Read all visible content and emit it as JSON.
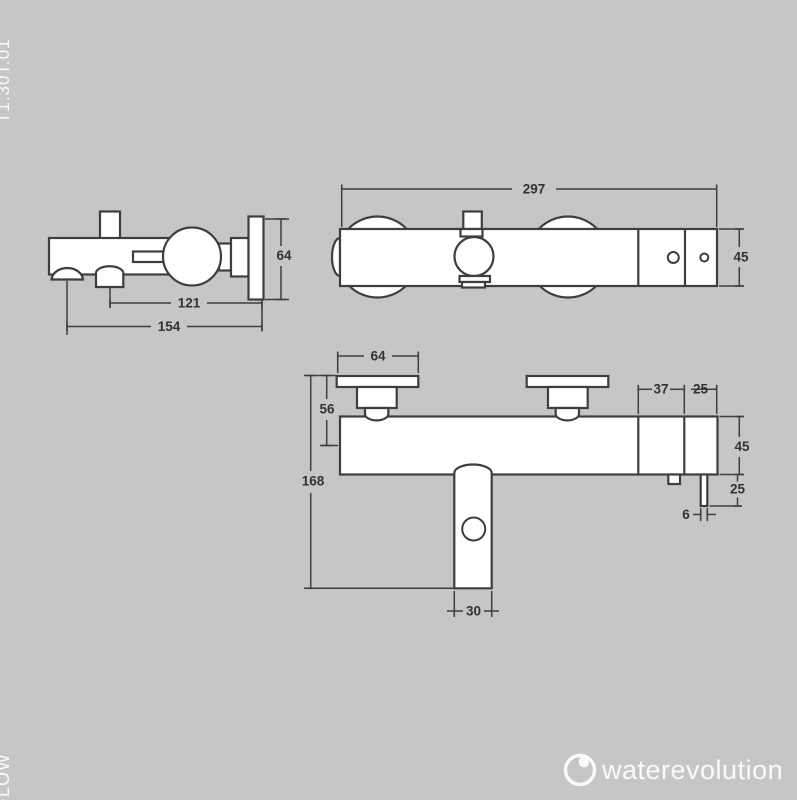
{
  "header": {
    "product_code": "T1.30T.01"
  },
  "footer": {
    "series": "FLOW",
    "brand": "waterevolution"
  },
  "colors": {
    "background": "#c5c6c8",
    "line": "#3e3e40",
    "fill": "#ffffff",
    "text_dark": "#333335",
    "text_light": "#fafafa"
  },
  "dims": {
    "side_spout_depth": "154",
    "side_diverter_depth": "121",
    "side_plate": "64",
    "top_width": "297",
    "top_depth": "45",
    "front_plate_width": "64",
    "front_plate_drop": "56",
    "front_height": "168",
    "front_span_37": "37",
    "front_span_25": "25",
    "front_body_45": "45",
    "front_pin_25": "25",
    "front_pin_6": "6",
    "front_spout_30": "30"
  }
}
